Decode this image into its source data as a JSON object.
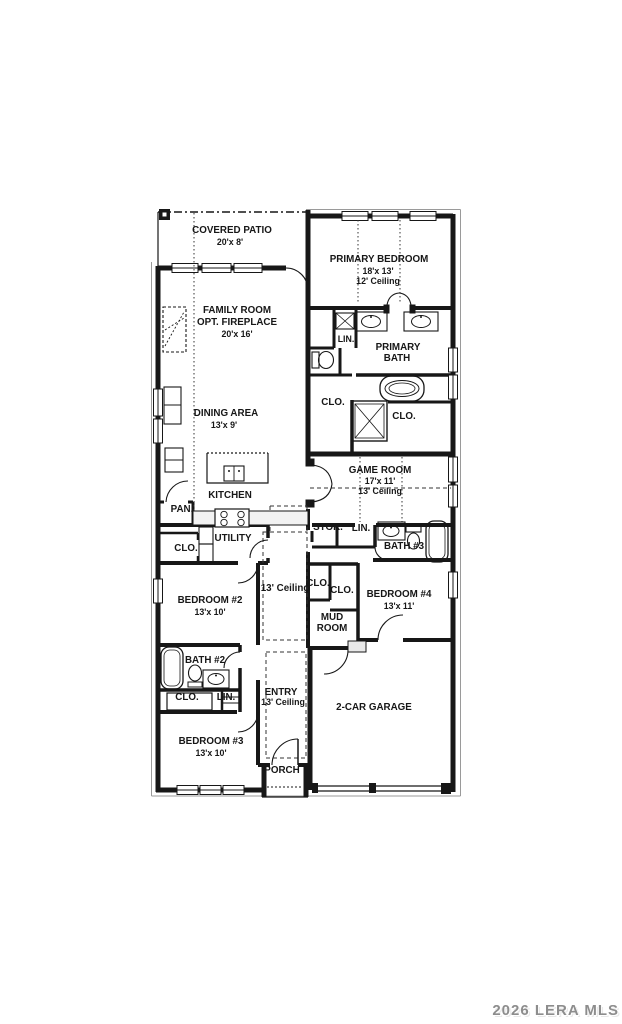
{
  "watermark": "2026 LERA MLS",
  "colors": {
    "line": "#171717",
    "watermark": "#8d8d8d"
  },
  "rooms": {
    "covered_patio": {
      "name": "COVERED PATIO",
      "dims": "20'x 8'"
    },
    "primary_bedroom": {
      "name": "PRIMARY BEDROOM",
      "dims": "18'x 13'",
      "ceiling": "12' Ceiling"
    },
    "family_room": {
      "name": "FAMILY ROOM",
      "name2": "OPT. FIREPLACE",
      "dims": "20'x 16'"
    },
    "primary_bath": {
      "name": "PRIMARY",
      "name2": "BATH"
    },
    "lin_primary": {
      "name": "LIN."
    },
    "clo_bath_left": {
      "name": "CLO."
    },
    "clo_bath_right": {
      "name": "CLO."
    },
    "dining_area": {
      "name": "DINING AREA",
      "dims": "13'x 9'"
    },
    "kitchen": {
      "name": "KITCHEN"
    },
    "game_room": {
      "name": "GAME ROOM",
      "dims": "17'x 11'",
      "ceiling": "13' Ceiling"
    },
    "pantry": {
      "name": "PAN."
    },
    "storage": {
      "name": "STOR."
    },
    "linen_hall": {
      "name": "LIN."
    },
    "bath_3": {
      "name": "BATH #3"
    },
    "utility": {
      "name": "UTILITY"
    },
    "clo_utility": {
      "name": "CLO."
    },
    "hall_ceiling": {
      "name": "13' Ceiling"
    },
    "clo_bed4_a": {
      "name": "CLO."
    },
    "clo_bed4_b": {
      "name": "CLO."
    },
    "bedroom_2": {
      "name": "BEDROOM #2",
      "dims": "13'x 10'"
    },
    "bedroom_4": {
      "name": "BEDROOM #4",
      "dims": "13'x 11'"
    },
    "mud_room": {
      "name": "MUD",
      "name2": "ROOM"
    },
    "bath_2": {
      "name": "BATH #2"
    },
    "clo_bed2": {
      "name": "CLO."
    },
    "lin_bed2": {
      "name": "LIN."
    },
    "entry": {
      "name": "ENTRY",
      "ceiling": "13' Ceiling"
    },
    "bedroom_3": {
      "name": "BEDROOM #3",
      "dims": "13'x 10'"
    },
    "garage": {
      "name": "2-CAR GARAGE"
    },
    "porch": {
      "name": "PORCH"
    }
  }
}
